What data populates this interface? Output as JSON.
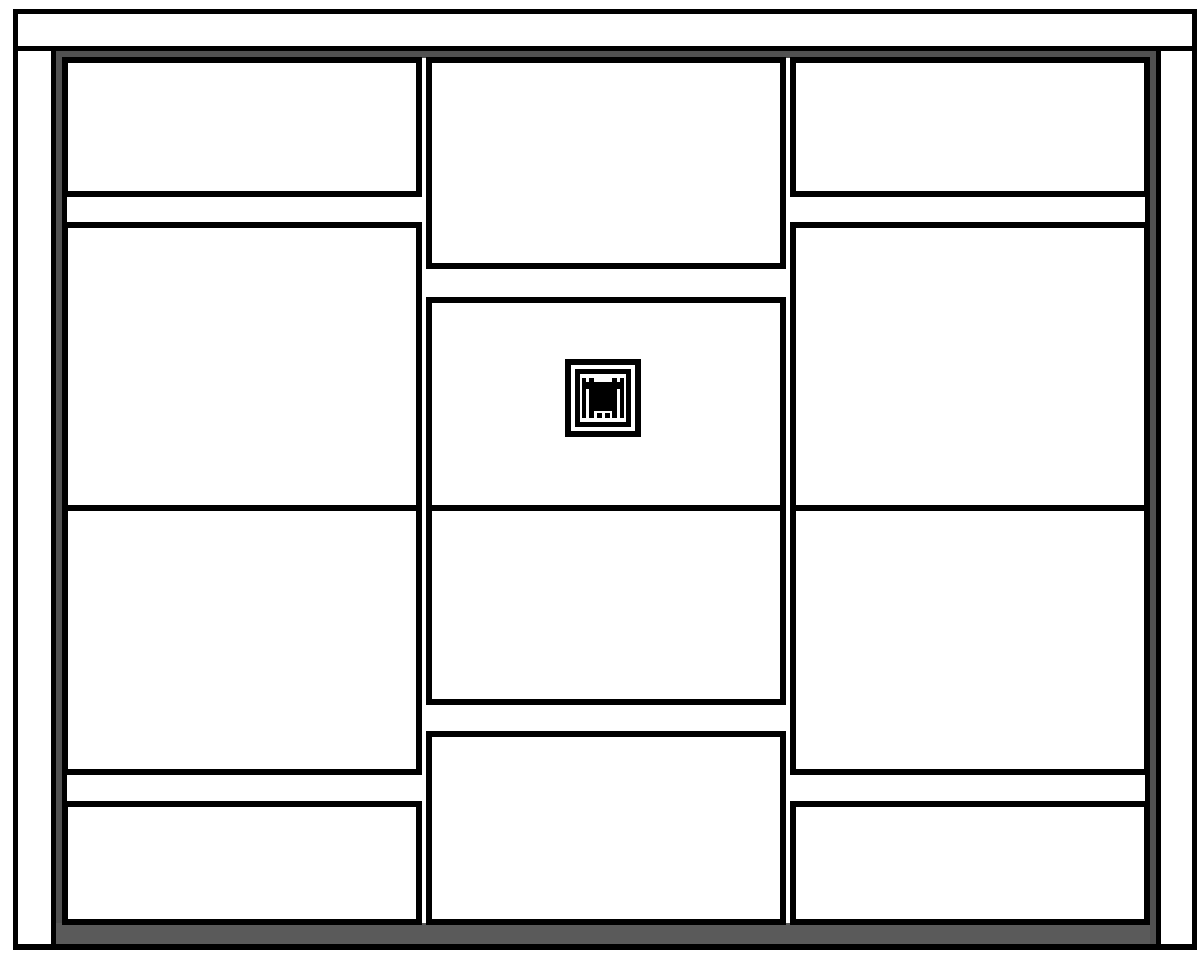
{
  "drawing": {
    "description": "Black-and-white front elevation of a cabinet / wardrobe: top cornice panel, two side panels, dark gray carcass strips and plinth, and three columns of four white door and drawer fronts; the center door carries a small square emblem",
    "canvas": {
      "width": 1203,
      "height": 960,
      "background": "#ffffff"
    },
    "colors": {
      "ink": "#000000",
      "fill": "#ffffff",
      "carcass_gray": "#515151",
      "plinth_gray": "#5a5a5a"
    },
    "emblem": {
      "icon": "door-emblem-icon"
    },
    "parts": [
      {
        "name": "carcass-top-strip",
        "kind": "carcass",
        "x": 56,
        "y": 51,
        "w": 1094,
        "h": 7,
        "interactable": false
      },
      {
        "name": "carcass-left-strip",
        "kind": "carcass",
        "x": 56,
        "y": 51,
        "w": 6,
        "h": 894,
        "interactable": false
      },
      {
        "name": "carcass-right-strip",
        "kind": "carcass",
        "x": 1150,
        "y": 51,
        "w": 7,
        "h": 894,
        "interactable": false
      },
      {
        "name": "plinth",
        "kind": "plinth",
        "x": 56,
        "y": 923,
        "w": 1094,
        "h": 22,
        "interactable": false
      },
      {
        "name": "carcass-left-edge-gap-top",
        "kind": "line",
        "x": 62,
        "y": 197,
        "w": 5,
        "h": 25,
        "interactable": false
      },
      {
        "name": "carcass-left-edge-gap-bottom",
        "kind": "line",
        "x": 62,
        "y": 775,
        "w": 5,
        "h": 26,
        "interactable": false
      },
      {
        "name": "carcass-right-edge-gap-top",
        "kind": "line",
        "x": 1145,
        "y": 197,
        "w": 5,
        "h": 25,
        "interactable": false
      },
      {
        "name": "carcass-right-edge-gap-bottom",
        "kind": "line",
        "x": 1145,
        "y": 775,
        "w": 5,
        "h": 26,
        "interactable": false
      },
      {
        "name": "top-cornice-panel",
        "kind": "panel",
        "x": 13,
        "y": 9,
        "w": 1184,
        "h": 42,
        "interactable": false
      },
      {
        "name": "left-side-panel",
        "kind": "panel",
        "x": 13,
        "y": 46,
        "w": 43,
        "h": 904,
        "interactable": false
      },
      {
        "name": "right-side-panel",
        "kind": "panel",
        "x": 1156,
        "y": 46,
        "w": 41,
        "h": 904,
        "interactable": false
      },
      {
        "name": "front-left-top-drawer",
        "kind": "front",
        "x": 62,
        "y": 57,
        "w": 360,
        "h": 140,
        "interactable": true
      },
      {
        "name": "front-left-upper-door",
        "kind": "front",
        "x": 62,
        "y": 222,
        "w": 360,
        "h": 289,
        "interactable": true
      },
      {
        "name": "front-left-lower-door",
        "kind": "front",
        "x": 62,
        "y": 505,
        "w": 360,
        "h": 270,
        "interactable": true
      },
      {
        "name": "front-left-bottom-drawer",
        "kind": "front",
        "x": 62,
        "y": 801,
        "w": 360,
        "h": 124,
        "interactable": true
      },
      {
        "name": "front-middle-top-door",
        "kind": "front",
        "x": 426,
        "y": 57,
        "w": 360,
        "h": 212,
        "interactable": true
      },
      {
        "name": "front-middle-emblem-door",
        "kind": "front",
        "x": 426,
        "y": 297,
        "w": 360,
        "h": 214,
        "interactable": true
      },
      {
        "name": "front-middle-lower-door",
        "kind": "front",
        "x": 426,
        "y": 505,
        "w": 360,
        "h": 200,
        "interactable": true
      },
      {
        "name": "front-middle-bottom-door",
        "kind": "front",
        "x": 426,
        "y": 731,
        "w": 360,
        "h": 194,
        "interactable": true
      },
      {
        "name": "front-right-top-drawer",
        "kind": "front",
        "x": 790,
        "y": 57,
        "w": 360,
        "h": 140,
        "interactable": true
      },
      {
        "name": "front-right-upper-door",
        "kind": "front",
        "x": 790,
        "y": 222,
        "w": 360,
        "h": 289,
        "interactable": true
      },
      {
        "name": "front-right-lower-door",
        "kind": "front",
        "x": 790,
        "y": 505,
        "w": 360,
        "h": 270,
        "interactable": true
      },
      {
        "name": "front-right-bottom-drawer",
        "kind": "front",
        "x": 790,
        "y": 801,
        "w": 360,
        "h": 124,
        "interactable": true
      },
      {
        "name": "bottom-edge-line",
        "kind": "line",
        "x": 13,
        "y": 944,
        "w": 1184,
        "h": 6,
        "interactable": false
      },
      {
        "name": "door-emblem-icon",
        "kind": "emblem",
        "x": 565,
        "y": 359,
        "w": 76,
        "h": 78,
        "interactable": true
      }
    ]
  }
}
